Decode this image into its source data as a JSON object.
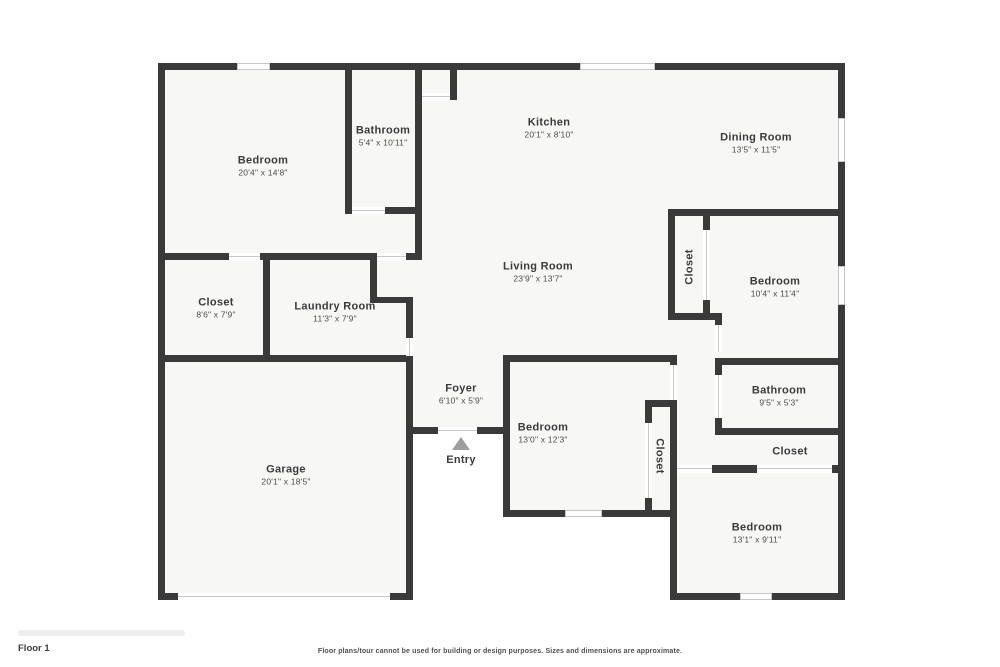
{
  "plan": {
    "rooms": [
      {
        "name": "Bedroom",
        "dims": "20'4\" x 14'8\"",
        "cx": 263,
        "cy": 166,
        "vertical": null
      },
      {
        "name": "Bathroom",
        "dims": "5'4\" x 10'11\"",
        "cx": 383,
        "cy": 136,
        "vertical": null
      },
      {
        "name": "Kitchen",
        "dims": "20'1\" x 8'10\"",
        "cx": 549,
        "cy": 128,
        "vertical": null
      },
      {
        "name": "Dining Room",
        "dims": "13'5\" x 11'5\"",
        "cx": 756,
        "cy": 143,
        "vertical": null
      },
      {
        "name": "Living Room",
        "dims": "23'9\" x 13'7\"",
        "cx": 538,
        "cy": 272,
        "vertical": null
      },
      {
        "name": "Closet",
        "dims": "",
        "cx": 690,
        "cy": 267,
        "vertical": "up"
      },
      {
        "name": "Bedroom",
        "dims": "10'4\" x 11'4\"",
        "cx": 775,
        "cy": 287,
        "vertical": null
      },
      {
        "name": "Closet",
        "dims": "8'6\" x 7'9\"",
        "cx": 216,
        "cy": 308,
        "vertical": null
      },
      {
        "name": "Laundry Room",
        "dims": "11'3\" x 7'9\"",
        "cx": 335,
        "cy": 312,
        "vertical": null
      },
      {
        "name": "Foyer",
        "dims": "6'10\" x 5'9\"",
        "cx": 461,
        "cy": 394,
        "vertical": null
      },
      {
        "name": "Bedroom",
        "dims": "13'0\" x 12'3\"",
        "cx": 543,
        "cy": 433,
        "vertical": null
      },
      {
        "name": "Closet",
        "dims": "",
        "cx": 659,
        "cy": 456,
        "vertical": "down"
      },
      {
        "name": "Bathroom",
        "dims": "9'5\" x 5'3\"",
        "cx": 779,
        "cy": 396,
        "vertical": null
      },
      {
        "name": "Closet",
        "dims": "",
        "cx": 790,
        "cy": 452,
        "vertical": null
      },
      {
        "name": "Bedroom",
        "dims": "13'1\" x 9'11\"",
        "cx": 757,
        "cy": 533,
        "vertical": null
      },
      {
        "name": "Garage",
        "dims": "20'1\" x 18'5\"",
        "cx": 286,
        "cy": 475,
        "vertical": null
      }
    ],
    "entry": {
      "label": "Entry"
    }
  },
  "footer": {
    "floor_label": "Floor 1",
    "disclaimer": "Floor plans/tour cannot be used for building or design purposes. Sizes and dimensions are approximate."
  },
  "colors": {
    "wall": "#3a3a3a",
    "floor": "#f7f7f6",
    "line": "#c6c6c6",
    "text": "#3b3b3b",
    "arrow": "#9e9e9e"
  }
}
